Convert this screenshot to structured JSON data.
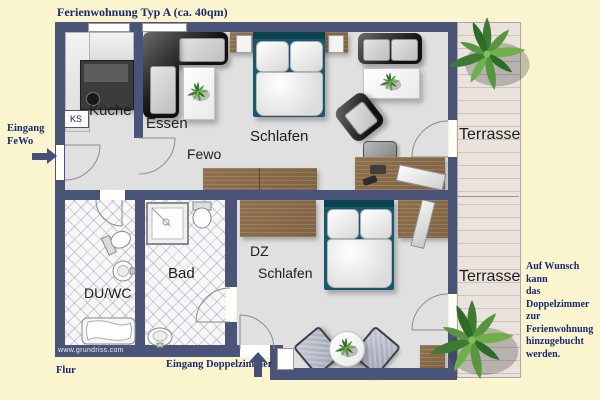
{
  "title": "Ferienwohnung Typ A (ca. 40qm)",
  "rooms": {
    "kueche": "Küche",
    "essen": "Essen",
    "fewo": "Fewo",
    "schlafen_fewo": "Schlafen",
    "terrasse_top": "Terrasse",
    "du_wc": "DU/WC",
    "bad": "Bad",
    "dz_line1": "DZ",
    "dz_line2": "Schlafen",
    "terrasse_bottom": "Terrasse"
  },
  "annotations": {
    "entrance_fewo_line1": "Eingang",
    "entrance_fewo_line2": "FeWo",
    "flur": "Flur",
    "entrance_dz": "Eingang Doppelzimmer",
    "ks": "KS",
    "watermark": "www.grundriss.com",
    "note_line1": "Auf Wunsch kann",
    "note_line2": "das Doppelzimmer",
    "note_line3": "zur Ferienwohnung",
    "note_line4": "hinzugebucht",
    "note_line5": "werden."
  },
  "colors": {
    "background": "#FAF4CF",
    "wall": "#4A5478",
    "floor": "#E0E0E0",
    "wood": "#866846",
    "bed_frame": "#17596C",
    "navy_text": "#1A2A72",
    "terrace_plank": "#EAE3DD"
  }
}
